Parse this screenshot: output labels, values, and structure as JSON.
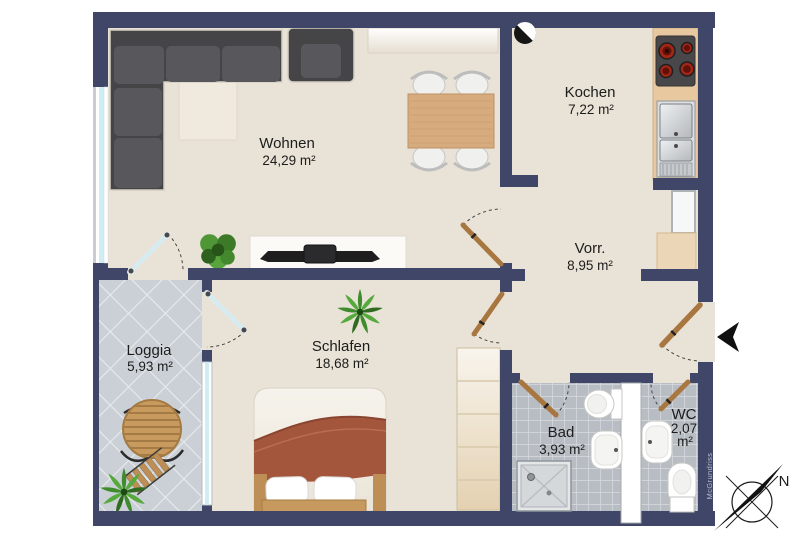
{
  "title": "Apartment floor plan",
  "rooms": [
    {
      "id": "wohnen",
      "name": "Wohnen",
      "area": "24,29 m²"
    },
    {
      "id": "kochen",
      "name": "Kochen",
      "area": "7,22 m²"
    },
    {
      "id": "vorraum",
      "name": "Vorr.",
      "area": "8,95 m²"
    },
    {
      "id": "schlafen",
      "name": "Schlafen",
      "area": "18,68 m²"
    },
    {
      "id": "loggia",
      "name": "Loggia",
      "area": "5,93 m²"
    },
    {
      "id": "bad",
      "name": "Bad",
      "area": "3,93 m²"
    },
    {
      "id": "wc",
      "name": "WC",
      "area_value": "2,07",
      "area_unit": "m²"
    }
  ],
  "compass": {
    "label": "N"
  },
  "watermark": {
    "text": "McGrundriss"
  },
  "colors": {
    "wall": "#3f4668",
    "floor": "#e9e2d6",
    "loggia_tile": "#cad0d5",
    "bath_tile": "#b8bdc4",
    "window_glass": "#cfeef3",
    "door_wood": "#a8763f",
    "counter": "#e7c89f",
    "sofa": "#454548",
    "burner_red": "#a22616"
  }
}
